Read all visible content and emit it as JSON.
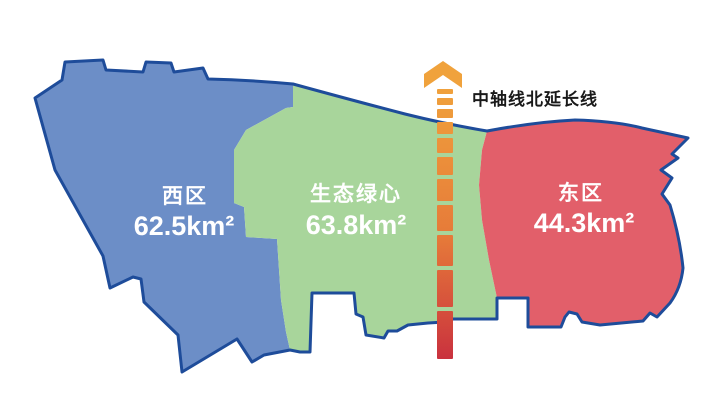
{
  "regions": [
    {
      "id": "west",
      "name": "西区",
      "area": "62.5km²",
      "color": "#6C8EC7"
    },
    {
      "id": "green-heart",
      "name": "生态绿心",
      "area": "63.8km²",
      "color": "#A8D59B"
    },
    {
      "id": "east",
      "name": "东区",
      "area": "44.3km²",
      "color": "#E25F6A"
    }
  ],
  "axis": {
    "label": "中轴线北延长线",
    "arrow_icon": "chevron-up-arrow",
    "arrow_color": "#F0A23C",
    "gradient_start": "#F0A23C",
    "gradient_mid": "#E67A39",
    "gradient_end": "#C9303E"
  },
  "colors": {
    "border": "#1E4C9A",
    "label_text": "#FFFFFF",
    "axis_label_text": "#1A1A1A",
    "background": "#FFFFFF"
  }
}
